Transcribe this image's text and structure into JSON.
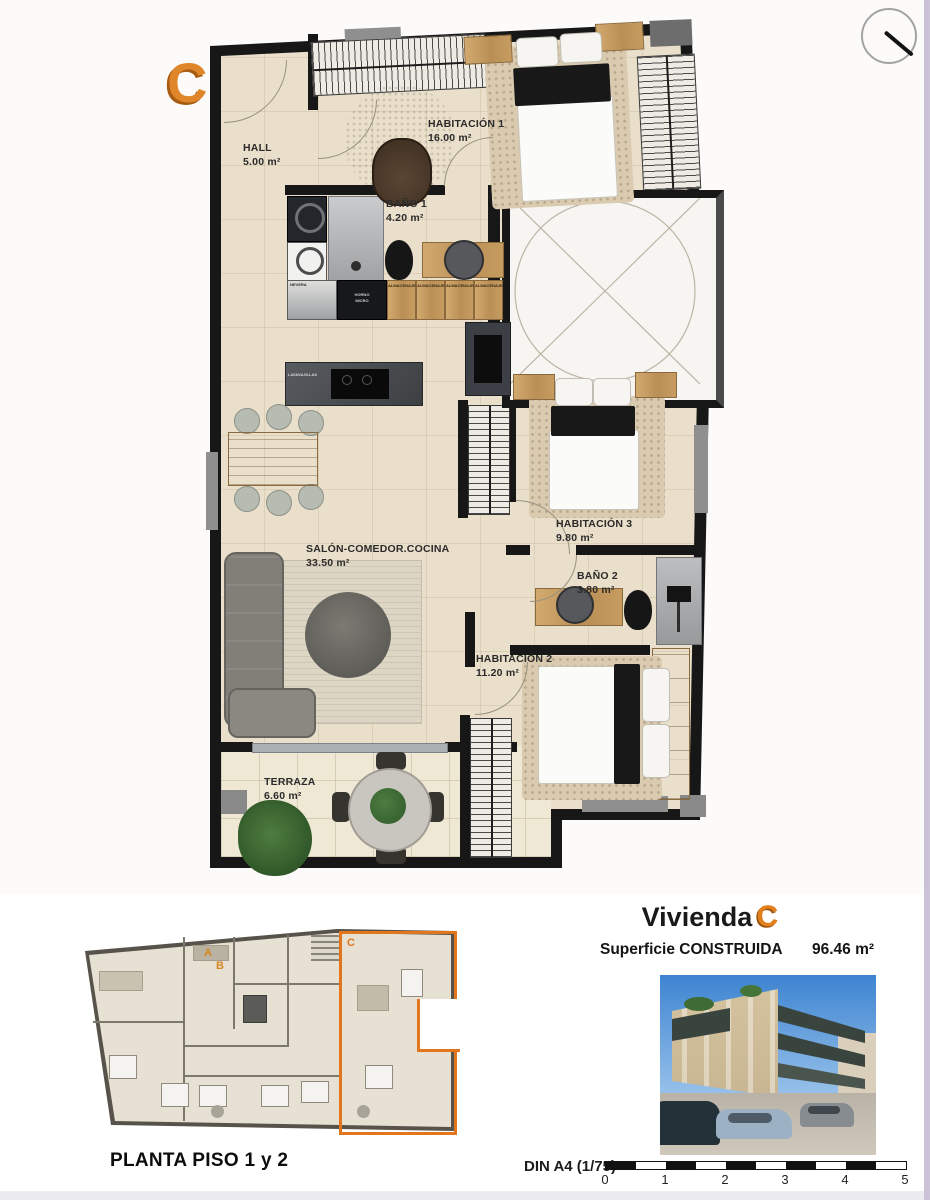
{
  "accent_orange": "#E2801D",
  "unit_letter_large": "C",
  "plan": {
    "rooms": [
      {
        "name": "HALL",
        "area": "5.00 m²"
      },
      {
        "name": "HABITACIÓN 1",
        "area": "16.00 m²"
      },
      {
        "name": "BAÑO 1",
        "area": "4.20 m²"
      },
      {
        "name": "SALÓN-COMEDOR.COCINA",
        "area": "33.50 m²"
      },
      {
        "name": "HABITACIÓN 3",
        "area": "9.80 m²"
      },
      {
        "name": "BAÑO 2",
        "area": "3.80 m²"
      },
      {
        "name": "HABITACIÓN 2",
        "area": "11.20 m²"
      },
      {
        "name": "TERRAZA",
        "area": "6.60 m²"
      }
    ],
    "appliance_labels": {
      "washer": "LAVADO",
      "fridge": "NEVERA",
      "oven_line1": "HORNO",
      "oven_line2": "MICRO",
      "cabinet": "ALMACENAJE",
      "dishwasher": "LAVAVAJILLAS"
    }
  },
  "overview": {
    "caption": "PLANTA PISO 1 y 2",
    "unit_a": "A",
    "unit_b": "B",
    "unit_c": "C"
  },
  "info": {
    "title": "Vivienda",
    "unit": "C",
    "surface_label": "Superficie CONSTRUIDA",
    "surface_value": "96.46 m²"
  },
  "scale": {
    "din_label": "DIN A4 (1/75)",
    "ticks": [
      "0",
      "1",
      "2",
      "3",
      "4",
      "5"
    ]
  }
}
